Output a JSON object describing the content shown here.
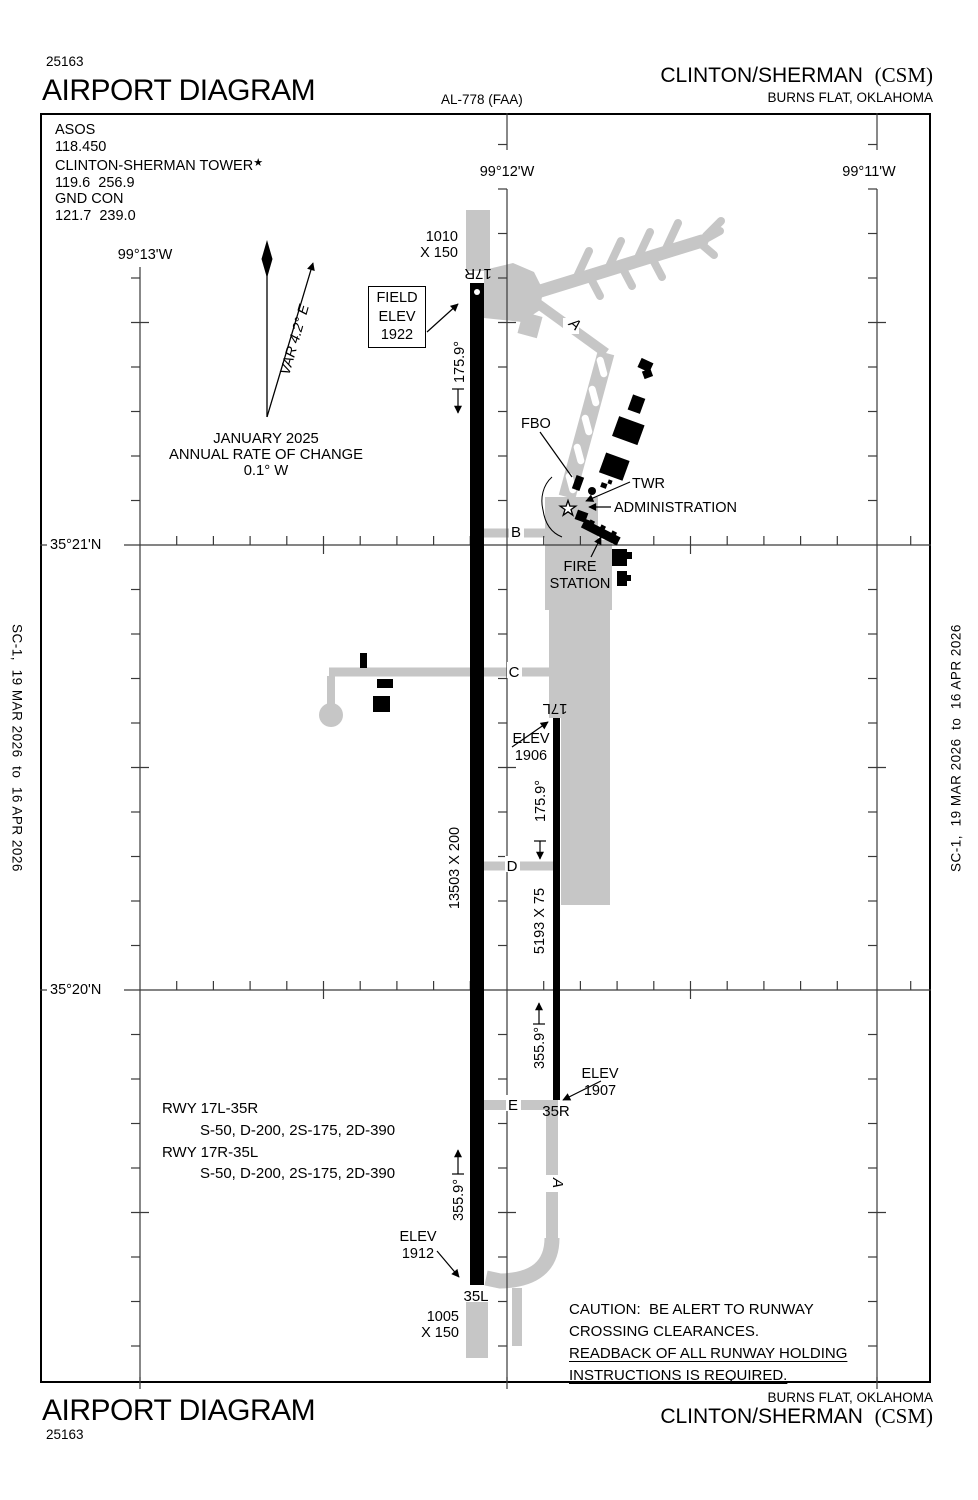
{
  "header_top": {
    "chart_number": "25163",
    "title": "AIRPORT DIAGRAM",
    "al_number": "AL-778 (FAA)",
    "airport_name": "CLINTON/SHERMAN",
    "airport_code": "(CSM)",
    "city": "BURNS FLAT, OKLAHOMA"
  },
  "header_bottom": {
    "title": "AIRPORT DIAGRAM",
    "chart_number": "25163",
    "airport_name": "CLINTON/SHERMAN",
    "airport_code": "(CSM)",
    "city": "BURNS FLAT, OKLAHOMA"
  },
  "edge_note": "SC-1,  19 MAR 2026  to  16 APR 2026",
  "comms": {
    "asos_label": "ASOS",
    "asos_freq": "118.450",
    "tower_label": "CLINTON-SHERMAN TOWER",
    "tower_star": "★",
    "tower_freq": "119.6  256.9",
    "gnd_label": "GND CON",
    "gnd_freq": "121.7  239.0"
  },
  "compass": {
    "variation": "VAR 4.2° E",
    "date": "JANUARY 2025",
    "rate1": "ANNUAL RATE OF CHANGE",
    "rate2": "0.1° W"
  },
  "field_elev": {
    "l1": "FIELD",
    "l2": "ELEV",
    "l3": "1922"
  },
  "coords": {
    "lon_13": "99°13'W",
    "lon_12": "99°12'W",
    "lon_11": "99°11'W",
    "lat_21": "35°21'N",
    "lat_20": "35°20'N"
  },
  "runway_main": {
    "north_id": "17R",
    "south_id": "35L",
    "dimensions": "13503 X 200",
    "south_heading": "175.9°",
    "north_heading": "355.9°",
    "north_overrun_1": "1010",
    "north_overrun_2": "X 150",
    "south_overrun_1": "1005",
    "south_overrun_2": "X 150",
    "south_elev_1": "ELEV",
    "south_elev_2": "1912"
  },
  "runway_parallel": {
    "north_id": "17L",
    "south_id": "35R",
    "dimensions": "5193 X 75",
    "south_heading": "175.9°",
    "north_heading": "355.9°",
    "north_elev_1": "ELEV",
    "north_elev_2": "1906",
    "south_elev_1": "ELEV",
    "south_elev_2": "1907"
  },
  "taxiways": {
    "a_north": "A",
    "a_south": "A",
    "b": "B",
    "c": "C",
    "d": "D",
    "e": "E"
  },
  "facilities": {
    "fbo": "FBO",
    "twr": "TWR",
    "admin": "ADMINISTRATION",
    "fire_1": "FIRE",
    "fire_2": "STATION"
  },
  "runway_data": {
    "rwy1": "RWY 17L-35R",
    "rwy1_strength": "S-50, D-200, 2S-175, 2D-390",
    "rwy2": "RWY 17R-35L",
    "rwy2_strength": "S-50, D-200, 2S-175, 2D-390"
  },
  "caution": {
    "l1": "CAUTION:  BE ALERT TO RUNWAY",
    "l2": "CROSSING CLEARANCES.",
    "l3": "READBACK OF ALL RUNWAY HOLDING",
    "l4": "INSTRUCTIONS IS REQUIRED."
  },
  "colors": {
    "pavement": "#c6c6c6",
    "runway": "#000000",
    "grid": "#3a3a3a"
  }
}
